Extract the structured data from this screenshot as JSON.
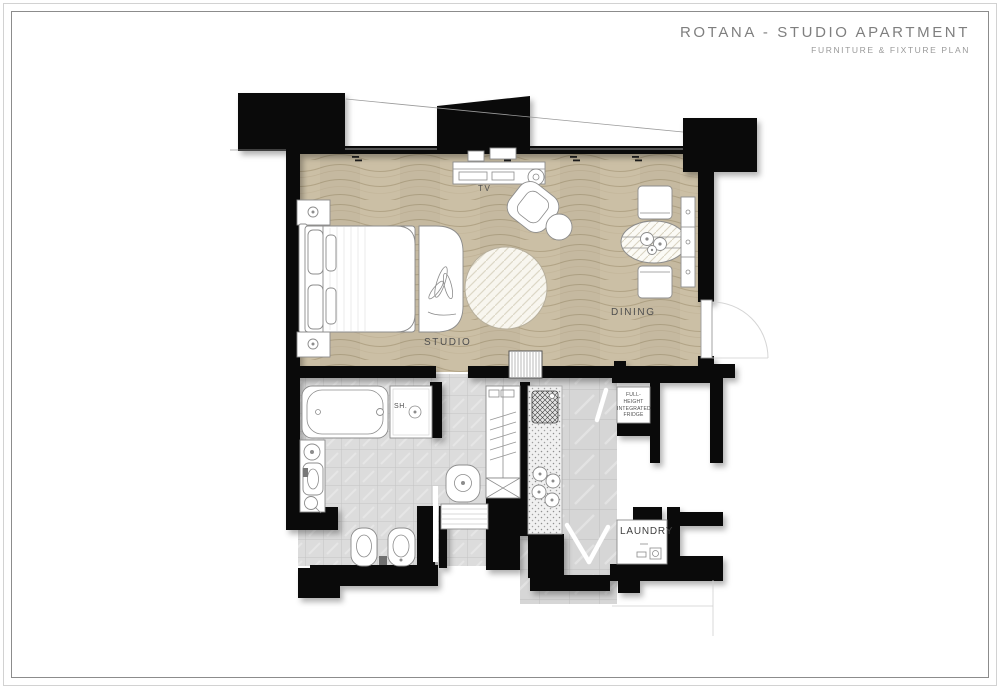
{
  "titleblock": {
    "title": "ROTANA - STUDIO APARTMENT",
    "subtitle": "FURNITURE & FIXTURE PLAN"
  },
  "plan": {
    "room_labels": {
      "studio": "STUDIO",
      "dining": "DINING",
      "laundry": "LAUNDRY"
    },
    "fixture_labels": {
      "tv": "TV",
      "shower": "SH.",
      "fridge": "FULL-HEIGHT INTEGRATED FRIDGE"
    },
    "symbols": [
      "king-bed",
      "nightstand-lamp",
      "foot-bench-plant",
      "tv-console",
      "side-table",
      "lounge-chair",
      "ottoman",
      "round-rug",
      "dining-table",
      "dining-chair",
      "sideboard",
      "entry-door",
      "bathtub",
      "shower-drain",
      "vanity-basin",
      "washbasin",
      "bidet",
      "toilet",
      "sliding-door",
      "wardrobe",
      "luggage-rack",
      "kitchen-counter",
      "kitchen-sink",
      "cooktop-burners",
      "integrated-fridge",
      "washing-machine",
      "door-swing"
    ],
    "colors": {
      "wall": "#0a0a0a",
      "wood_floor": "#cbbfa5",
      "wood_grain": "#b2a486",
      "tile_floor": "#dcdcdc",
      "tile_line": "#c3c3c3",
      "hall_tile": "#d6d6d6",
      "hall_tile_line": "#bfbfbf",
      "furniture_stroke": "#8c8c8c",
      "label_text": "#4f4f4f",
      "title_text": "#7f7f7f",
      "subtitle_text": "#9a9a9a",
      "border_outer": "#d2d2d2",
      "border_inner": "#8c8c8c"
    }
  }
}
